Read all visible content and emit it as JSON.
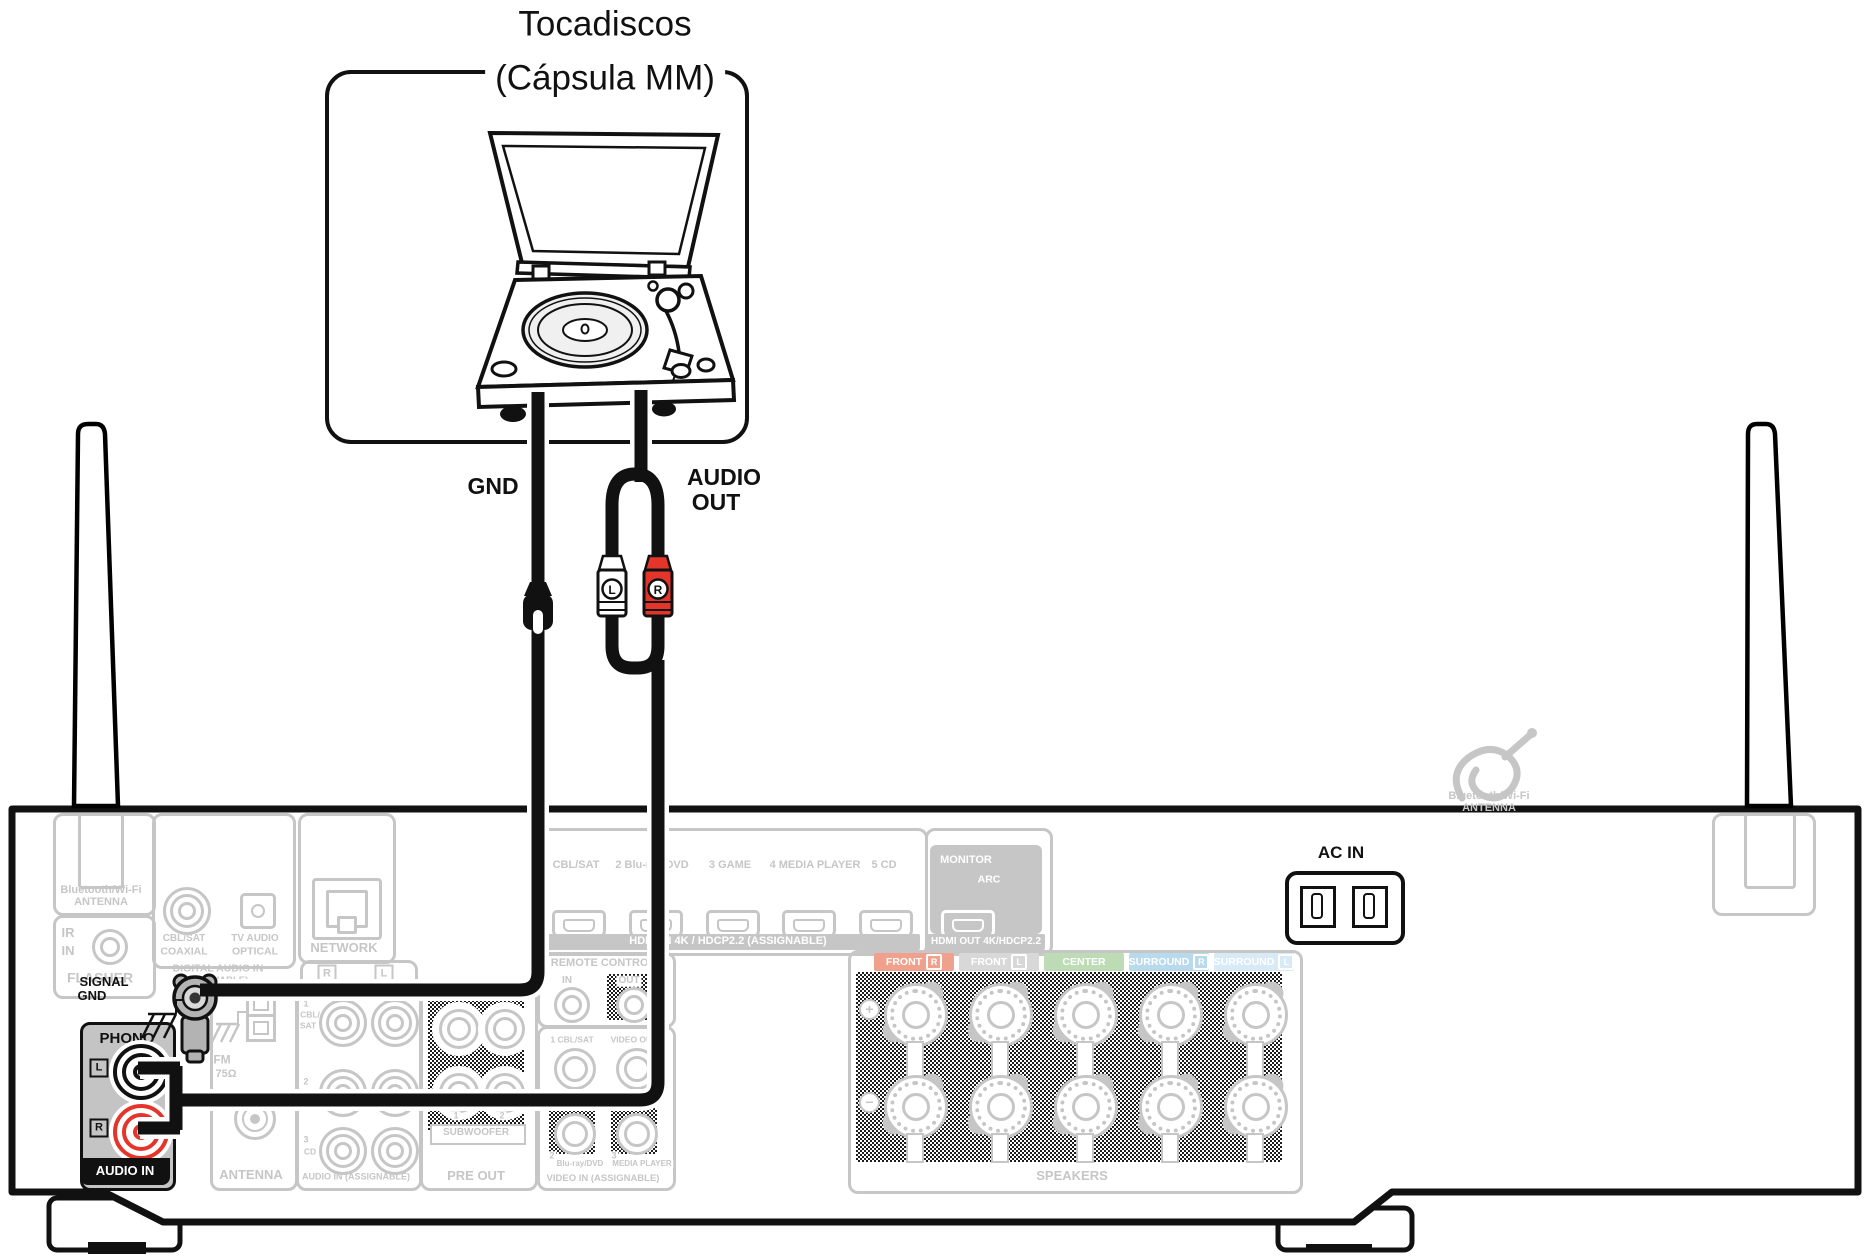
{
  "colors": {
    "highlight_red": "#e5352b",
    "ghost_gray": "#c6c6c6",
    "phono_box_gray": "#c4c4c4",
    "front_r_bg": "#f0a18d",
    "front_l_bg": "#d8d8d8",
    "center_bg": "#bddcb6",
    "surround_r_bg": "#b8daec",
    "surround_l_bg": "#d7eaf5"
  },
  "turntable": {
    "title_line1": "Tocadiscos",
    "title_line2": "(Cápsula MM)"
  },
  "cables": {
    "gnd": "GND",
    "audio_line1": "AUDIO",
    "audio_line2": "OUT",
    "plug_l": "L",
    "plug_r": "R"
  },
  "receiver": {
    "bt_left": {
      "line1": "Bluetooth/Wi-Fi",
      "line2": "ANTENNA"
    },
    "flasher": {
      "ir": "IR",
      "in": "IN",
      "label": "FLASHER"
    },
    "digital": {
      "coax_l1": "CBL/SAT",
      "coax_l2": "COAXIAL",
      "opt_l1": "TV AUDIO",
      "opt_l2": "OPTICAL",
      "group_l1": "DIGITAL AUDIO IN",
      "group_l2": "(ASSIGNABLE)"
    },
    "network": {
      "label": "NETWORK",
      "r": "R",
      "l": "L"
    },
    "signal_gnd": {
      "line1": "SIGNAL",
      "line2": "GND"
    },
    "phono": {
      "label": "PHONO",
      "l": "L",
      "r": "R",
      "audio_in": "AUDIO IN"
    },
    "antenna_col": {
      "am": "AM",
      "fm": "FM",
      "ohm": "75Ω",
      "label": "ANTENNA"
    },
    "audio_col": {
      "r1n": "1",
      "r1a": "CBL/",
      "r1b": "SAT",
      "r2n": "2",
      "r3n": "3",
      "r3": "CD",
      "label": "AUDIO IN (ASSIGNABLE)"
    },
    "pre_out": {
      "n1": "1",
      "n2": "2",
      "sub": "SUBWOOFER",
      "label": "PRE OUT"
    },
    "remote": {
      "label": "REMOTE CONTROL",
      "in": "IN",
      "out": "OUT"
    },
    "video": {
      "r1a": "1 CBL/SAT",
      "r1b": "VIDEO OUT",
      "r2n": "2",
      "r2": "Blu-ray/DVD",
      "r3n": "3",
      "r3": "MEDIA PLAYER",
      "label": "VIDEO IN (ASSIGNABLE)"
    },
    "hdmi": {
      "in1": "CBL/SAT",
      "in2": "2 Blu-ray/DVD",
      "in3": "3 GAME",
      "in4": "4 MEDIA PLAYER",
      "in5": "5 CD",
      "in_band": "HDMI IN  4K / HDCP2.2 (ASSIGNABLE)",
      "monitor": "MONITOR",
      "arc": "ARC",
      "out_band": "HDMI OUT 4K/HDCP2.2"
    },
    "speakers": {
      "chips": [
        {
          "name": "FRONT",
          "letter": "R"
        },
        {
          "name": "FRONT",
          "letter": "L"
        },
        {
          "name": "CENTER",
          "letter": ""
        },
        {
          "name": "SURROUND",
          "letter": "R"
        },
        {
          "name": "SURROUND",
          "letter": "L"
        }
      ],
      "plus": "+",
      "minus": "−",
      "label": "SPEAKERS"
    },
    "ac_in": "AC IN",
    "bt_right": {
      "line1": "Bluetooth/Wi-Fi",
      "line2": "ANTENNA"
    }
  }
}
